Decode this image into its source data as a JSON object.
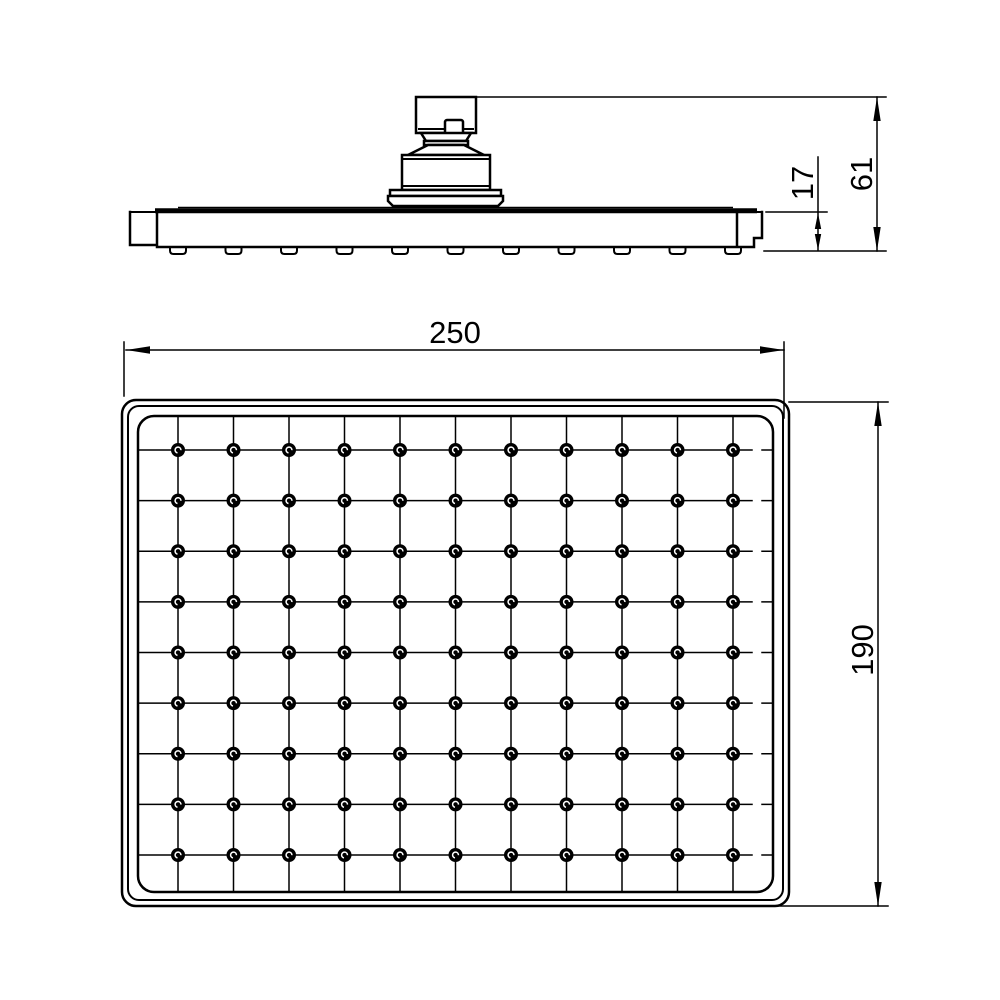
{
  "page": {
    "kind": "technical-dimension-drawing",
    "subject": "rectangular overhead rain shower head, side elevation and face plan views",
    "background_color": "#ffffff",
    "line_color": "#000000"
  },
  "dimensions": {
    "plan_width": {
      "value": "250"
    },
    "plan_height": {
      "value": "190"
    },
    "overall_height": {
      "value": "61"
    },
    "plate_thickness": {
      "value": "17"
    }
  },
  "drawing": {
    "grid": {
      "columns": 11,
      "rows": 9,
      "nozzle_total": 99,
      "col_start": 178,
      "col_step": 55.5,
      "row_start": 450,
      "row_step": 50.625,
      "line_top": 416,
      "line_bottom": 892,
      "line_left": 138,
      "line_right": 752,
      "dash_start": 762,
      "dash_end": 772,
      "nozzle_radius": 7,
      "swirl_radius": 2.9
    },
    "side_bumps": {
      "count": 11,
      "top_y": 247,
      "bottom_y": 254,
      "half_width": 8
    }
  }
}
